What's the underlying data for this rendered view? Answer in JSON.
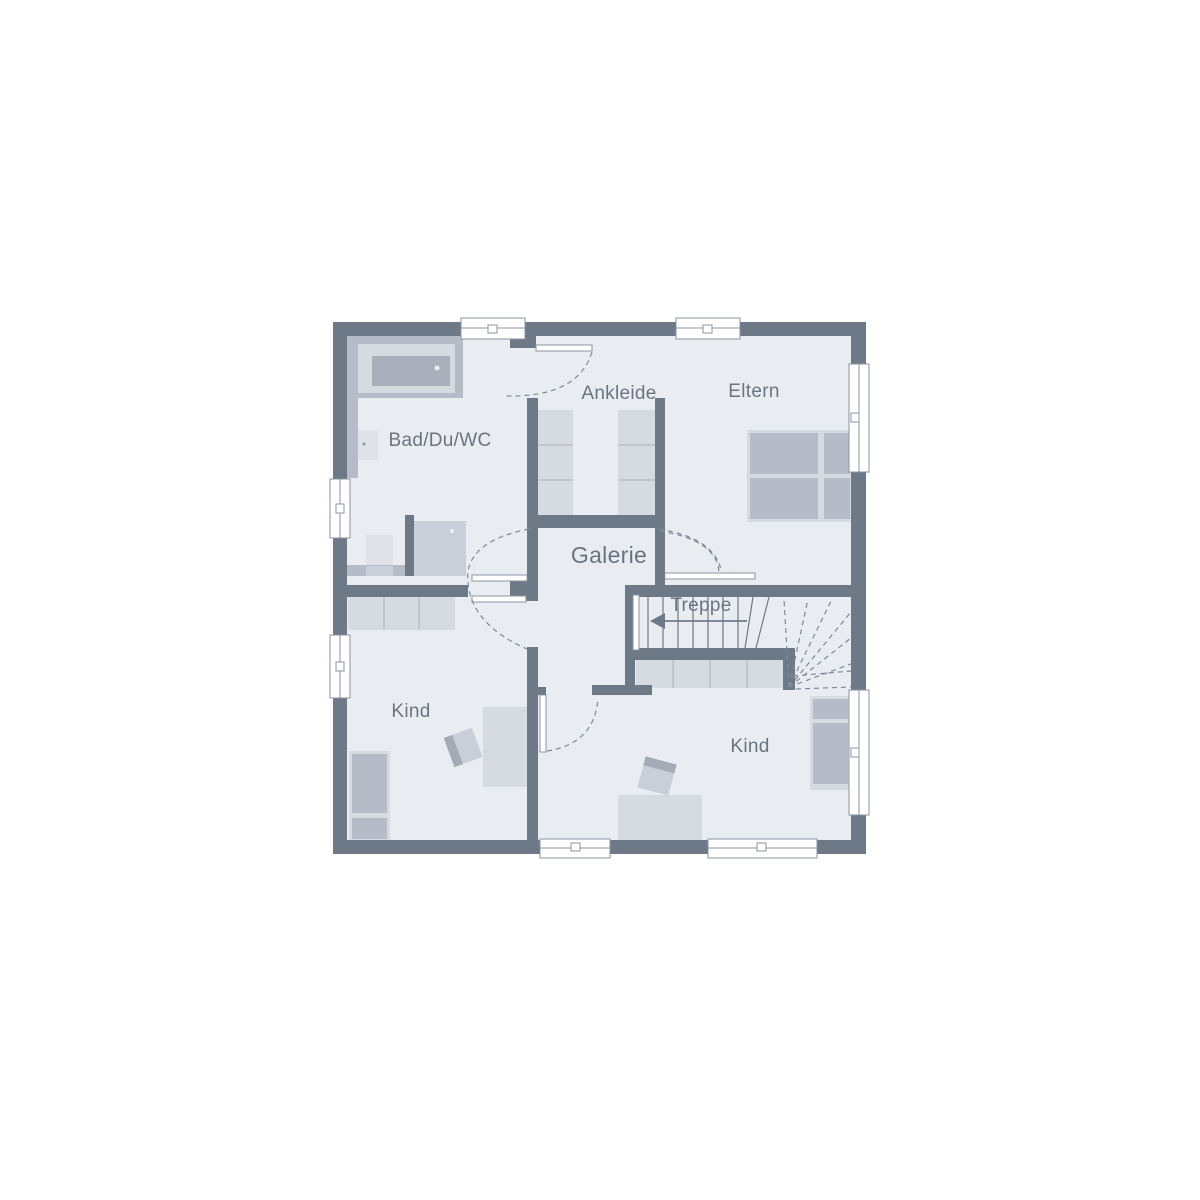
{
  "rooms": [
    {
      "id": "bad",
      "label": "Bad/Du/WC"
    },
    {
      "id": "ankleide",
      "label": "Ankleide"
    },
    {
      "id": "eltern",
      "label": "Eltern"
    },
    {
      "id": "galerie",
      "label": "Galerie"
    },
    {
      "id": "treppe",
      "label": "Treppe"
    },
    {
      "id": "kind_links",
      "label": "Kind"
    },
    {
      "id": "kind_rechts",
      "label": "Kind"
    }
  ],
  "colors": {
    "wall": "#6e7988",
    "floor": "#e9edf2",
    "furniture_light": "#d6dae1",
    "furniture_medium": "#b5bcc7",
    "fixture_light": "#dfe3e9",
    "fixture_mid": "#c9cfd8",
    "tub_inner": "#a9b0bb",
    "window_frame": "#8b94a1",
    "dash_line": "#7e8896",
    "text": "#6b7481"
  }
}
